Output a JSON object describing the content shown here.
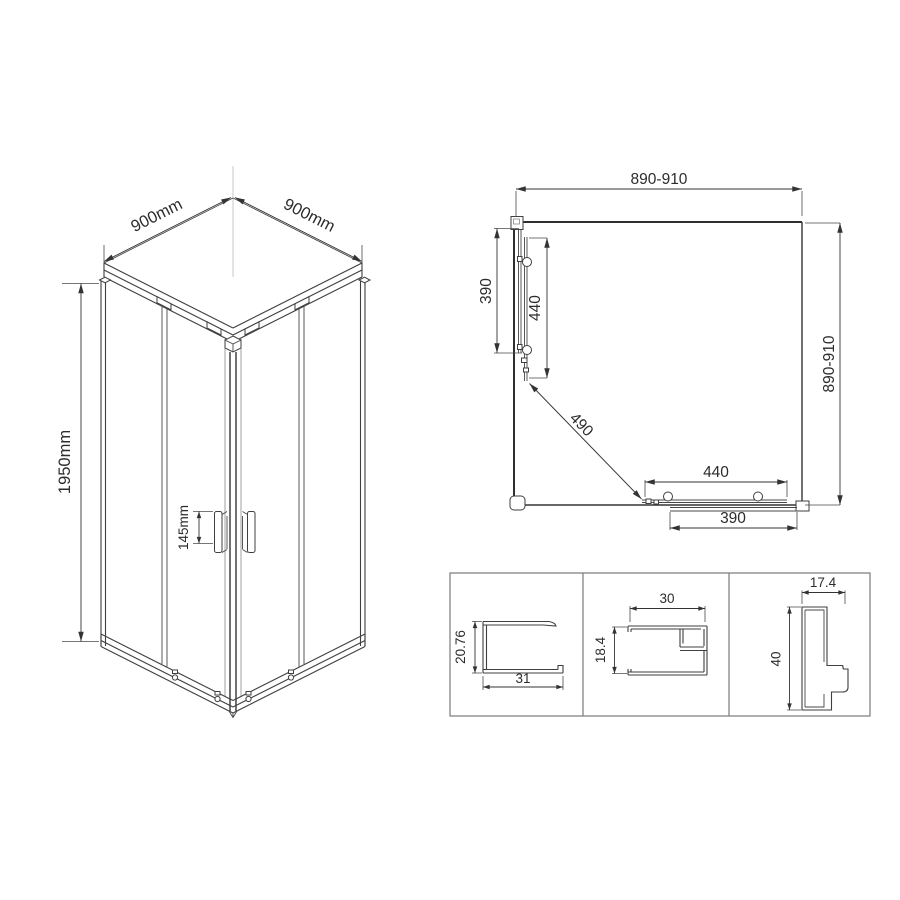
{
  "drawing": {
    "title": "shower-enclosure-technical-drawing",
    "colors": {
      "background": "#ffffff",
      "line": "#3f3f3f",
      "dimension_text": "#2c2c2c",
      "axis_line": "#c8c8c8",
      "detail_box_border": "#7a7a7a"
    }
  },
  "isometric_view": {
    "dim_width_left": "900mm",
    "dim_width_right": "900mm",
    "dim_height": "1950mm",
    "dim_handle_height": "145mm"
  },
  "plan_view": {
    "dim_width_top": "890-910",
    "dim_depth_right": "890-910",
    "dim_left_panel": "390",
    "dim_left_door": "440",
    "dim_diagonal_opening": "490",
    "dim_bottom_door": "440",
    "dim_bottom_panel": "390"
  },
  "profile_details": {
    "profiles": [
      {
        "name": "bottom-rail-profile",
        "dim_height": "20.76",
        "dim_width": "31"
      },
      {
        "name": "top-rail-profile",
        "dim_width": "30",
        "dim_height": "18.4"
      },
      {
        "name": "vertical-post-profile",
        "dim_width": "17.4",
        "dim_height": "40"
      }
    ]
  }
}
